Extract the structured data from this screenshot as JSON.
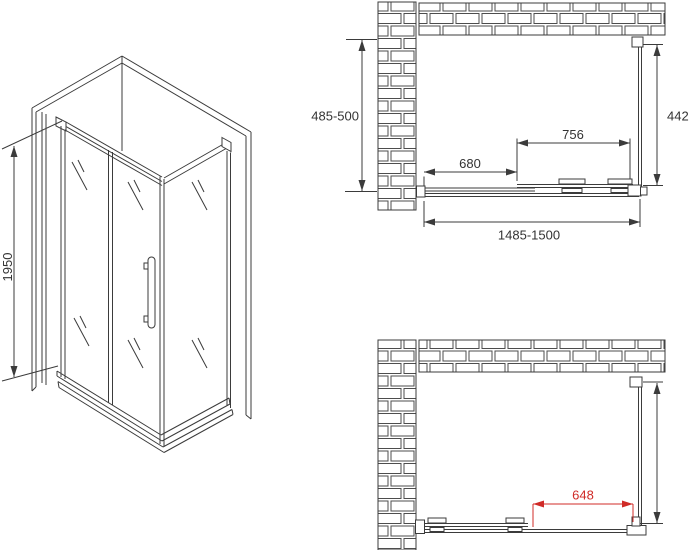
{
  "isometric": {
    "height_label": "1950"
  },
  "top_plan": {
    "depth_label": "485-500",
    "side_panel_width_label": "442",
    "sliding_panel_width_label": "756",
    "fixed_section_width_label": "680",
    "overall_width_label": "1485-1500"
  },
  "bottom_plan": {
    "door_opening_label": "648"
  },
  "colors": {
    "line": "#3b3b3b",
    "dimension_red": "#d02b27",
    "text": "#333333"
  }
}
